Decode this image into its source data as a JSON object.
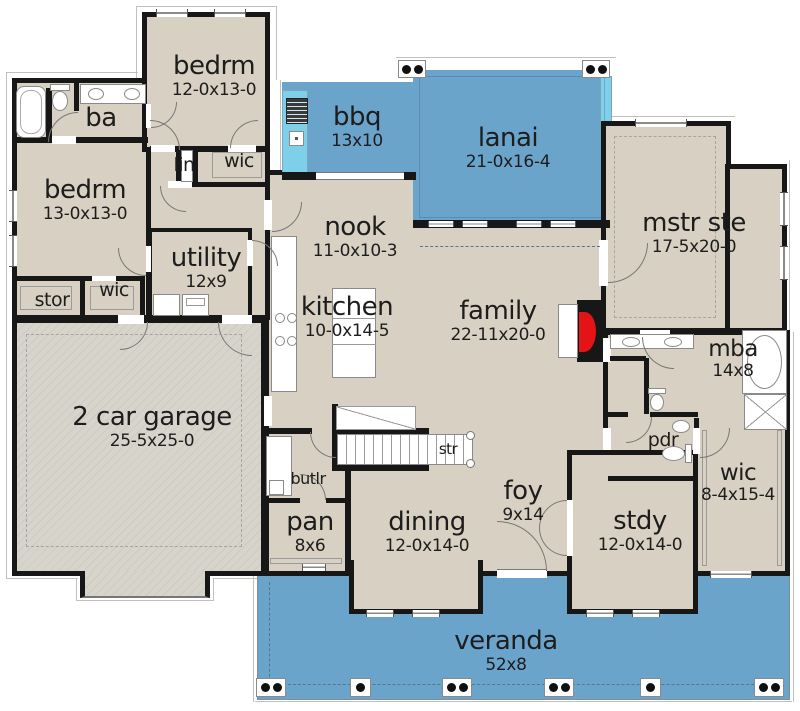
{
  "meta": {
    "type": "house-floor-plan"
  },
  "colors": {
    "room_fill": "#d8d0c2",
    "garage_fill": "#d7d4cc",
    "outdoor_blue": "#6ba4cb",
    "counter_cyan": "#7ed0ea",
    "wall_black": "#171717",
    "fireplace_red": "#e41317",
    "text": "#1d1d1d"
  },
  "rooms": [
    {
      "id": "bedrm-top",
      "label": "bedrm",
      "dims": "12-0x13-0"
    },
    {
      "id": "ba",
      "label": "ba",
      "dims": ""
    },
    {
      "id": "bedrm-left",
      "label": "bedrm",
      "dims": "13-0x13-0"
    },
    {
      "id": "lin",
      "label": "lin",
      "dims": ""
    },
    {
      "id": "wic-top",
      "label": "wic",
      "dims": ""
    },
    {
      "id": "bbq",
      "label": "bbq",
      "dims": "13x10"
    },
    {
      "id": "lanai",
      "label": "lanai",
      "dims": "21-0x16-4"
    },
    {
      "id": "nook",
      "label": "nook",
      "dims": "11-0x10-3"
    },
    {
      "id": "mstr-ste",
      "label": "mstr ste",
      "dims": "17-5x20-0"
    },
    {
      "id": "utility",
      "label": "utility",
      "dims": "12x9"
    },
    {
      "id": "kitchen",
      "label": "kitchen",
      "dims": "10-0x14-5"
    },
    {
      "id": "family",
      "label": "family",
      "dims": "22-11x20-0"
    },
    {
      "id": "stor",
      "label": "stor",
      "dims": ""
    },
    {
      "id": "wic-left",
      "label": "wic",
      "dims": ""
    },
    {
      "id": "garage",
      "label": "2 car garage",
      "dims": "25-5x25-0"
    },
    {
      "id": "mba",
      "label": "mba",
      "dims": "14x8"
    },
    {
      "id": "pdr",
      "label": "pdr",
      "dims": ""
    },
    {
      "id": "wic-right",
      "label": "wic",
      "dims": "8-4x15-4"
    },
    {
      "id": "str",
      "label": "str",
      "dims": ""
    },
    {
      "id": "butlr",
      "label": "butlr",
      "dims": ""
    },
    {
      "id": "pan",
      "label": "pan",
      "dims": "8x6"
    },
    {
      "id": "dining",
      "label": "dining",
      "dims": "12-0x14-0"
    },
    {
      "id": "foy",
      "label": "foy",
      "dims": "9x14"
    },
    {
      "id": "stdy",
      "label": "stdy",
      "dims": "12-0x14-0"
    },
    {
      "id": "veranda",
      "label": "veranda",
      "dims": "52x8"
    }
  ]
}
